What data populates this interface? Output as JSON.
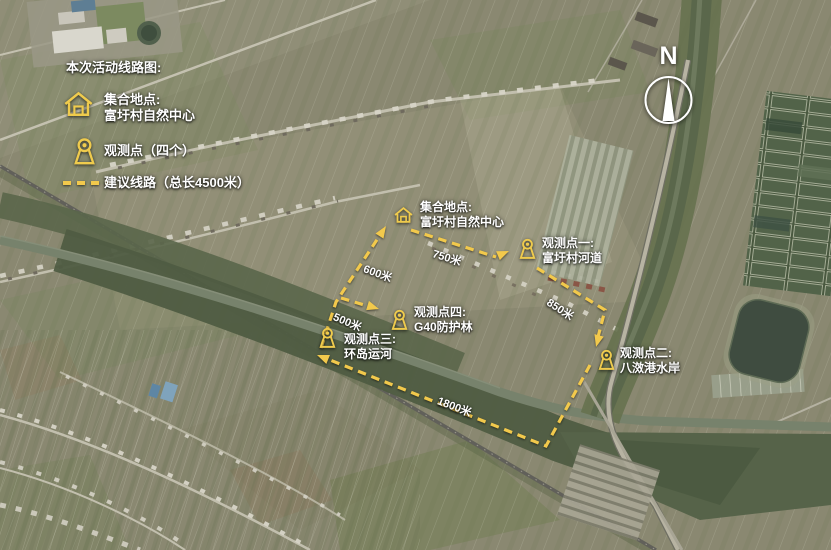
{
  "legend": {
    "title": "本次活动线路图:",
    "items": [
      {
        "icon": "house-icon",
        "line1": "集合地点:",
        "line2": "富圩村自然中心"
      },
      {
        "icon": "observation-pin-icon",
        "line1": "观测点（四个）",
        "line2": ""
      },
      {
        "icon": "dashed-route-sample",
        "line1": "建议线路（总长4500米）",
        "line2": ""
      }
    ]
  },
  "compass": {
    "label": "N"
  },
  "markers": [
    {
      "id": "meeting-point",
      "icon": "house-icon",
      "line1": "集合地点:",
      "line2": "富圩村自然中心"
    },
    {
      "id": "observation-1",
      "icon": "pin-icon",
      "line1": "观测点一:",
      "line2": "富圩村河道"
    },
    {
      "id": "observation-2",
      "icon": "pin-icon",
      "line1": "观测点二:",
      "line2": "八滧港水岸"
    },
    {
      "id": "observation-3",
      "icon": "pin-icon",
      "line1": "观测点三:",
      "line2": "环岛运河"
    },
    {
      "id": "observation-4",
      "icon": "pin-icon",
      "line1": "观测点四:",
      "line2": "G40防护林"
    }
  ],
  "distances": [
    {
      "label": "750米"
    },
    {
      "label": "850米"
    },
    {
      "label": "600米"
    },
    {
      "label": "500米"
    },
    {
      "label": "1800米"
    }
  ],
  "colors": {
    "route": "#F2C94C",
    "icon": "#EFCB4D",
    "label_text": "#FFFFFF"
  }
}
